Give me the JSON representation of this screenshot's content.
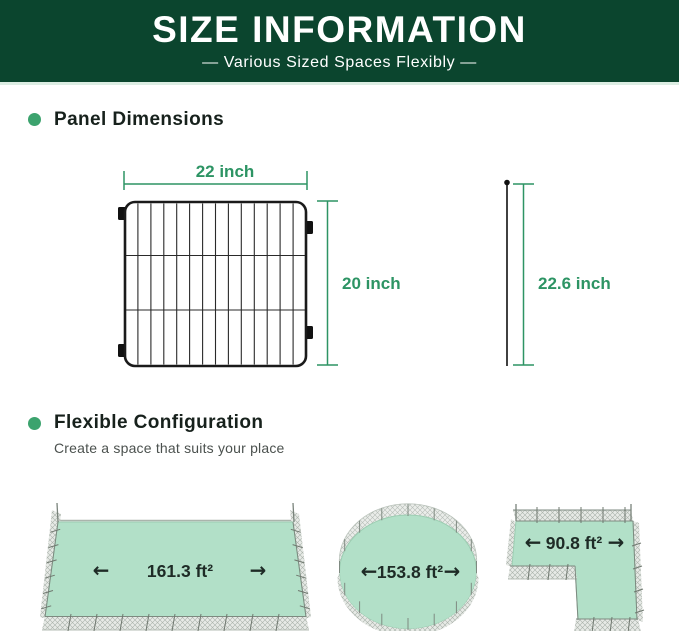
{
  "header": {
    "title": "SIZE INFORMATION",
    "subtitle": "—  Various Sized Spaces Flexibly  —"
  },
  "panel_section": {
    "heading": "Panel Dimensions"
  },
  "panel_diagram": {
    "width_label": "22 inch",
    "height_label": "20 inch",
    "stake_height_label": "22.6 inch"
  },
  "config_section": {
    "heading": "Flexible Configuration",
    "subheading": "Create a space that suits your place"
  },
  "configurations": [
    {
      "shape": "rectangle",
      "area_label": "161.3 ft²"
    },
    {
      "shape": "circle",
      "area_label": "153.8 ft²"
    },
    {
      "shape": "l-shape",
      "area_label": "90.8 ft²"
    }
  ],
  "icons": {
    "arrow_left": "←",
    "arrow_right": "→"
  },
  "colors": {
    "header_bg": "#0b452e",
    "header_underline": "#dcede3",
    "dimension_green": "#2d9464",
    "bullet_green": "#3ca36e",
    "area_fill": "#b2e0c8",
    "label_dark": "#1e2b26",
    "fence_gray": "#a9b1aa"
  }
}
